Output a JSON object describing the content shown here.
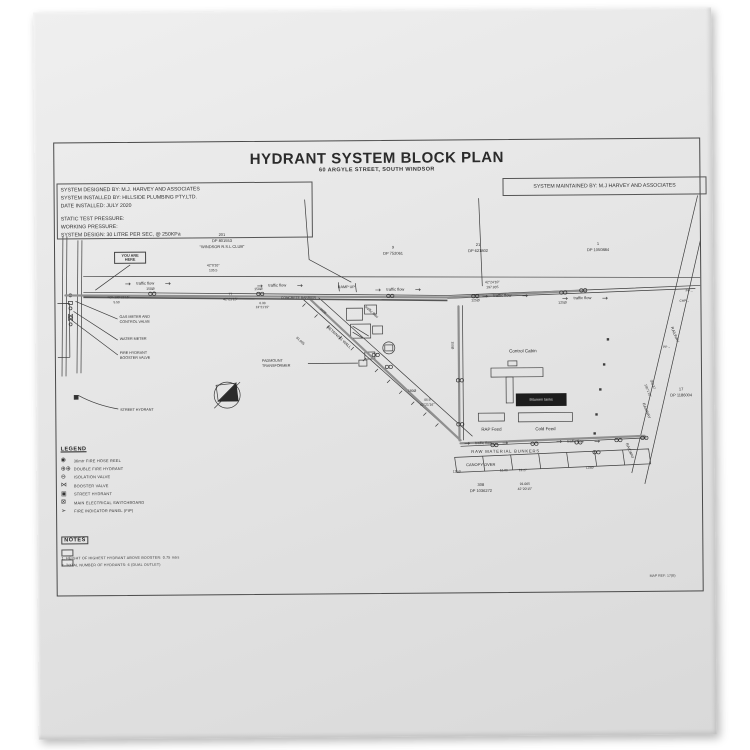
{
  "title": {
    "main": "HYDRANT SYSTEM BLOCK PLAN",
    "sub": "60 ARGYLE STREET, SOUTH WINDSOR"
  },
  "info_left": {
    "block1": [
      "SYSTEM DESIGNED BY: M.J. HARVEY AND ASSOCIATES",
      "SYSTEM INSTALLED BY: HILLSIDE PLUMBING PTY.LTD.",
      "DATE INSTALLED: JULY 2020"
    ],
    "block2": [
      "STATIC TEST PRESSURE:",
      "WORKING PRESSURE:",
      "SYSTEM DESIGN: 30 LITRE PER SEC, @ 250KPa"
    ]
  },
  "info_right": {
    "text": "SYSTEM MAINTAINED BY: M.J HARVEY AND ASSOCIATES"
  },
  "legend": {
    "heading": "LEGEND",
    "items": [
      {
        "icon": "fire-hose-reel-icon",
        "glyph": "◉",
        "label": "36mtr FIRE HOSE REEL"
      },
      {
        "icon": "double-fire-hydrant-icon",
        "glyph": "⊕⊕",
        "label": "DOUBLE FIRE HYDRANT"
      },
      {
        "icon": "isolation-valve-icon",
        "glyph": "⊖",
        "label": "ISOLATION VALVE"
      },
      {
        "icon": "booster-valve-icon",
        "glyph": "⋈",
        "label": "BOOSTER VALVE"
      },
      {
        "icon": "street-hydrant-icon",
        "glyph": "▣",
        "label": "STREET HYDRANT"
      },
      {
        "icon": "main-electrical-switchboard-icon",
        "glyph": "⊠",
        "label": "MAIN ELECTRICAL SWITCHBOARD"
      },
      {
        "icon": "fire-indicator-panel-icon",
        "glyph": "➢",
        "label": "FIRE INDICATOR PANEL (FIP)"
      }
    ]
  },
  "notes": {
    "heading": "NOTES",
    "items": [
      "1.   HEIGHT OF HIGHEST HYDRANT ABOVE BOOSTER: 0.75 mtrs",
      "2.   TOTAL NUMBER OF HYDRANTS: 6 (DUAL OUTLET)"
    ]
  },
  "map_ref": "MAP REF: 17(B)",
  "plan": {
    "labels": [
      {
        "t": "201",
        "x": 167,
        "y": 93,
        "s": 4
      },
      {
        "t": "DP 801553",
        "x": 167,
        "y": 99,
        "s": 4
      },
      {
        "t": "“WINDSOR R.S.L CLUB”",
        "x": 167,
        "y": 105,
        "s": 4
      },
      {
        "t": "9",
        "x": 338,
        "y": 107,
        "s": 4
      },
      {
        "t": "DP 752061",
        "x": 338,
        "y": 113,
        "s": 4
      },
      {
        "t": "21",
        "x": 423,
        "y": 105,
        "s": 4
      },
      {
        "t": "DP 621802",
        "x": 423,
        "y": 111,
        "s": 4
      },
      {
        "t": "1",
        "x": 543,
        "y": 105,
        "s": 4
      },
      {
        "t": "DP 1050884",
        "x": 543,
        "y": 111,
        "s": 4
      },
      {
        "t": "17",
        "x": 625,
        "y": 251,
        "s": 4
      },
      {
        "t": "DP 1186004",
        "x": 625,
        "y": 257,
        "s": 4
      },
      {
        "t": "308",
        "x": 424,
        "y": 345,
        "s": 4
      },
      {
        "t": "DP 1036272",
        "x": 424,
        "y": 351,
        "s": 4
      },
      {
        "t": "YOU ARE HERE",
        "x": 75,
        "y": 115,
        "s": 3.8,
        "c": "boxed",
        "w": 26
      },
      {
        "t": "42°0'10\"",
        "x": 158,
        "y": 124,
        "s": 3.4
      },
      {
        "t": "135.5",
        "x": 158,
        "y": 129,
        "s": 3.4
      },
      {
        "t": "traffic flow",
        "x": 90,
        "y": 141,
        "s": 4
      },
      {
        "t": "traffic flow",
        "x": 222,
        "y": 144,
        "s": 4
      },
      {
        "t": "traffic flow",
        "x": 340,
        "y": 149,
        "s": 4
      },
      {
        "t": "traffic flow",
        "x": 447,
        "y": 156,
        "s": 4
      },
      {
        "t": "traffic flow",
        "x": 527,
        "y": 159,
        "s": 4
      },
      {
        "t": "150Ø",
        "x": 95,
        "y": 147,
        "s": 3.4
      },
      {
        "t": "150Ø",
        "x": 203,
        "y": 148,
        "s": 3.4
      },
      {
        "t": "125Ø",
        "x": 420,
        "y": 161,
        "s": 3.4
      },
      {
        "t": "125Ø",
        "x": 507,
        "y": 164,
        "s": 3.4
      },
      {
        "t": "RAMP  UP",
        "x": 291,
        "y": 146,
        "s": 3.8
      },
      {
        "t": "77",
        "x": 175,
        "y": 153,
        "s": 3.4
      },
      {
        "t": "42°21'15\"",
        "x": 175,
        "y": 158,
        "s": 3.4
      },
      {
        "t": "CONCRETE BARRIER",
        "x": 243,
        "y": 157,
        "s": 3.4
      },
      {
        "t": "6.33",
        "x": 207,
        "y": 162,
        "s": 3.2
      },
      {
        "t": "13°21'15\"",
        "x": 207,
        "y": 166,
        "s": 3.2
      },
      {
        "t": "42°24'10\"",
        "x": 437,
        "y": 143,
        "s": 3.4
      },
      {
        "t": "197.935",
        "x": 437,
        "y": 148,
        "s": 3.4
      },
      {
        "t": "=Ch 130°21'15\"",
        "x": 52,
        "y": 155,
        "s": 3.2,
        "a": "l"
      },
      {
        "t": "5.50",
        "x": 58,
        "y": 160,
        "s": 3.2,
        "a": "l"
      },
      {
        "t": "GAS METER AND",
        "x": 64,
        "y": 174,
        "s": 3.7,
        "a": "l"
      },
      {
        "t": "CONTROL VALVE",
        "x": 64,
        "y": 179,
        "s": 3.7,
        "a": "l"
      },
      {
        "t": "WATER METER",
        "x": 64,
        "y": 196,
        "s": 3.7,
        "a": "l"
      },
      {
        "t": "FIRE HYDRANT",
        "x": 64,
        "y": 210,
        "s": 3.7,
        "a": "l"
      },
      {
        "t": "BOOSTER VALVE",
        "x": 64,
        "y": 215,
        "s": 3.7,
        "a": "l"
      },
      {
        "t": "STREET HYDRANT",
        "x": 64,
        "y": 267,
        "s": 3.7,
        "a": "l"
      },
      {
        "t": "PADMOUNT",
        "x": 206,
        "y": 219,
        "s": 3.7,
        "a": "l"
      },
      {
        "t": "TRANSFORMER",
        "x": 206,
        "y": 224,
        "s": 3.7,
        "a": "l"
      },
      {
        "t": "RETAINING WALL",
        "x": 283,
        "y": 196,
        "s": 3.8,
        "r": 43
      },
      {
        "t": "traffic flow",
        "x": 316,
        "y": 171,
        "s": 3.7,
        "r": 43
      },
      {
        "t": "81.995",
        "x": 244,
        "y": 200,
        "s": 3.4,
        "r": 43
      },
      {
        "t": "100Ø",
        "x": 267,
        "y": 170,
        "s": 3.2,
        "r": 43
      },
      {
        "t": "180Ø",
        "x": 356,
        "y": 251,
        "s": 3.4
      },
      {
        "t": "44.9",
        "x": 371,
        "y": 260,
        "s": 3.4
      },
      {
        "t": "42°21'16\"",
        "x": 371,
        "y": 265,
        "s": 3.4
      },
      {
        "t": "150Ø",
        "x": 396,
        "y": 205,
        "s": 3.2,
        "r": 90
      },
      {
        "t": "Control Cabin",
        "x": 467,
        "y": 212,
        "s": 4.5
      },
      {
        "t": "Bitumen tanks",
        "x": 485,
        "y": 260,
        "s": 3.7,
        "c": "inv"
      },
      {
        "t": "RAP Feed",
        "x": 435,
        "y": 290,
        "s": 4.4
      },
      {
        "t": "Cold Feed",
        "x": 489,
        "y": 290,
        "s": 4.4
      },
      {
        "t": "RAW MATERIAL BUNKERS",
        "x": 449,
        "y": 312,
        "s": 4.2,
        "sp": 0.8
      },
      {
        "t": "CANOPY OVER",
        "x": 424,
        "y": 325,
        "s": 4
      },
      {
        "t": "125Ø",
        "x": 400,
        "y": 332,
        "s": 3.2
      },
      {
        "t": "12.80",
        "x": 447,
        "y": 331,
        "s": 3.2
      },
      {
        "t": "13.27",
        "x": 466,
        "y": 331,
        "s": 3.2
      },
      {
        "t": "125Ø",
        "x": 533,
        "y": 329,
        "s": 3.2
      },
      {
        "t": "91.065",
        "x": 468,
        "y": 345,
        "s": 3.4
      },
      {
        "t": "42°20'15\"",
        "x": 468,
        "y": 350,
        "s": 3.4
      },
      {
        "t": "traffic flow",
        "x": 427,
        "y": 303,
        "s": 3.7
      },
      {
        "t": "traffic flow",
        "x": 519,
        "y": 302,
        "s": 3.7
      },
      {
        "t": "RAILWAY",
        "x": 619,
        "y": 196,
        "s": 3.8,
        "r": 68
      },
      {
        "t": "RAILWAY",
        "x": 590,
        "y": 272,
        "s": 3.8,
        "r": 68
      },
      {
        "t": "RAILWAY",
        "x": 573,
        "y": 312,
        "s": 3.8,
        "r": 68
      },
      {
        "t": "PP→",
        "x": 634,
        "y": 153,
        "s": 3.2
      },
      {
        "t": "CHP→",
        "x": 629,
        "y": 163,
        "s": 3.2
      },
      {
        "t": "PP→",
        "x": 611,
        "y": 209,
        "s": 3.2
      },
      {
        "t": "358.87",
        "x": 596,
        "y": 246,
        "s": 3.2,
        "r": 68
      },
      {
        "t": "155°1'10\"",
        "x": 591,
        "y": 252,
        "s": 3.2,
        "r": 68
      }
    ]
  }
}
